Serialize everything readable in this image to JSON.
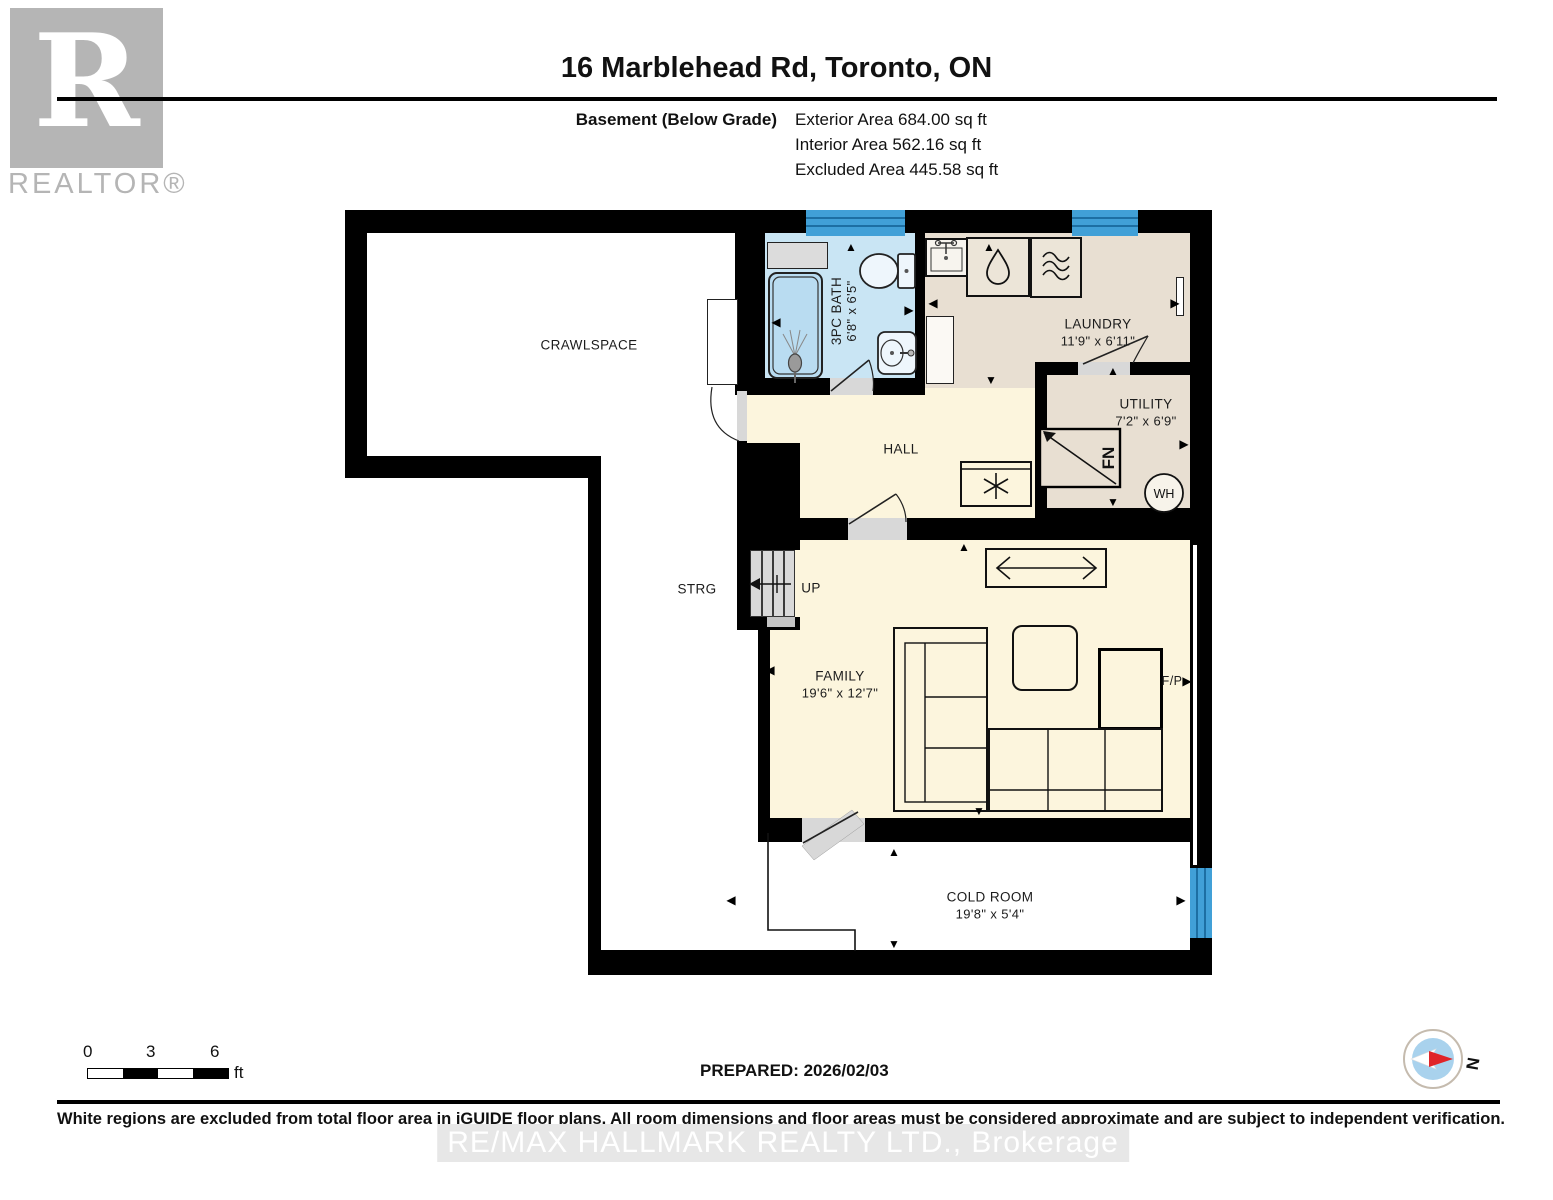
{
  "header": {
    "title": "16 Marblehead Rd, Toronto, ON",
    "floor_label": "Basement (Below Grade)",
    "area_lines": [
      "Exterior Area 684.00 sq ft",
      "Interior Area 562.16 sq ft",
      "Excluded Area 445.58 sq ft"
    ]
  },
  "logo": {
    "letter": "R",
    "wordmark": "REALTOR®"
  },
  "rooms": {
    "crawlspace": {
      "name": "CRAWLSPACE"
    },
    "bath": {
      "name": "3PC BATH",
      "dims": "6'8\" x 6'5\""
    },
    "laundry": {
      "name": "LAUNDRY",
      "dims": "11'9\" x 6'11\""
    },
    "utility": {
      "name": "UTILITY",
      "dims": "7'2\" x 6'9\""
    },
    "hall": {
      "name": "HALL"
    },
    "storage": {
      "name": "STRG"
    },
    "stairs": {
      "name": "UP"
    },
    "family": {
      "name": "FAMILY",
      "dims": "19'6\" x 12'7\""
    },
    "cold_room": {
      "name": "COLD ROOM",
      "dims": "19'8\" x 5'4\""
    }
  },
  "fixtures": {
    "furnace": "FN",
    "water_heater": "WH",
    "fireplace": "F/P"
  },
  "icons": {
    "up": "▲",
    "down": "▼",
    "left": "◀",
    "right": "▶"
  },
  "scale_bar": {
    "tick0": "0",
    "tick1": "3",
    "tick2": "6",
    "unit": "ft"
  },
  "prepared": "PREPARED: 2026/02/03",
  "compass": {
    "north": "N"
  },
  "footer": {
    "disclaimer": "White regions are excluded from total floor area in iGUIDE floor plans. All room dimensions and floor areas must be considered approximate and are subject to independent verification.",
    "watermark": "RE/MAX HALLMARK REALTY LTD., Brokerage"
  },
  "colors": {
    "wall": "#000000",
    "interior": "#fcf5dd",
    "service": "#e8dfd2",
    "bathroom": "#c9e5f4",
    "tub": "#b9dcf1",
    "window": "#41a0d7",
    "door": "#d8d8d8",
    "excluded": "#ffffff",
    "compass_north": "#e02428",
    "logo_gray": "#b5b5b5"
  }
}
